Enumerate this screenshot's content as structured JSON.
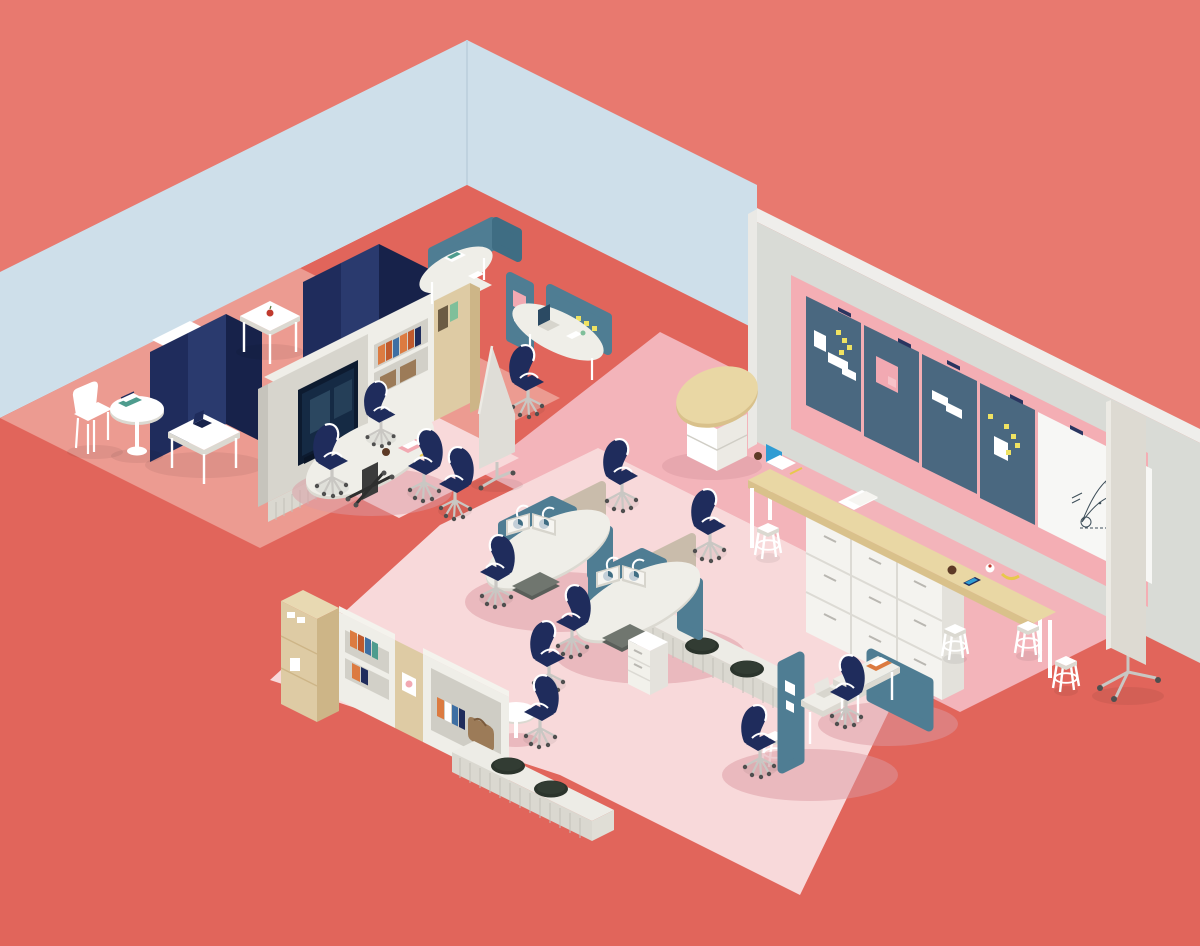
{
  "title": "Isometric open-plan office illustration",
  "colors": {
    "coral_bg": "#E8796F",
    "coral_floor": "#E1655B",
    "salmon_rug": "#EC9B91",
    "pink_rug_medium": "#F3B4BA",
    "pink_rug_pale": "#F8D9DA",
    "wall_blue": "#CEDFEA",
    "wall_gray_face": "#D9DBD6",
    "wall_gray_top": "#EFEEEB",
    "wall_pink_inset": "#F4AEB4",
    "board_slate": "#4A6880",
    "whiteboard": "#F7F7F5",
    "navy": "#1F2C5C",
    "navy_light": "#2A3A6E",
    "navy_dark": "#17224A",
    "slate_panel": "#4F7D93",
    "slate_dark": "#3F6D83",
    "white": "#FFFFFF",
    "desk_white": "#EFEEE8",
    "desk_edge": "#DBD9D1",
    "cabinet_gray": "#D7D5CD",
    "cabinet_gray_dark": "#C6C4BC",
    "plinth": "#DAD8D0",
    "slat_line": "#C2C0B8",
    "wood_tan": "#E9D7A4",
    "wood_tan_dark": "#D9C18B",
    "cabinet_beige": "#DECBA4",
    "cabinet_beige_dark": "#CDB587",
    "cabinet_beige_top": "#E8D9B2",
    "book_orange": "#DC7B41",
    "book_orange_deep": "#C05A2D",
    "book_blue": "#3E6FA3",
    "book_teal": "#4E9C8E",
    "book_brown": "#9C7B58",
    "tv_bezel": "#0D1B30",
    "tv_screen": "#152A44",
    "tv_reflection": "#3E5E78",
    "pouf_dark": "#2B342C",
    "pouf_light": "#39443A",
    "yellow_sticky": "#EFE262",
    "pink_paper": "#F2A9B2",
    "laptop_blue": "#2F9CD3",
    "mug_brown": "#5D3A26",
    "banana_yellow": "#E8C84C",
    "cushion_gray": "#70766F",
    "cushion_gray_dark": "#5A5F5A",
    "chair_frame": "#FFFFFF",
    "base_gray": "#C9C7C3",
    "caster_dark": "#4F4F4F",
    "shadow_pink": "#DC9AA2",
    "marker_ink": "#3D4E59",
    "apple_red": "#C03A2E",
    "plant_green": "#7FBF9A"
  },
  "scene": {
    "zones": [
      {
        "name": "focus-booths",
        "items": [
          "navy high-back privacy booths",
          "white in-booth tables",
          "two dark laptops",
          "white cafe chair",
          "round pedestal table with books",
          "square white table with apple"
        ]
      },
      {
        "name": "media-meeting-area",
        "items": [
          "gray media unit with wall TV",
          "white bookcase with books",
          "beige cabinet with green book",
          "white oval meeting table",
          "pink notepad, mug, pencil",
          "navy task chairs"
        ]
      },
      {
        "name": "cubicle-pods",
        "items": [
          "curved slate privacy panels",
          "laptop",
          "yellow sticky notes",
          "pink pinned paper",
          "navy task chair",
          "mobile pointed divider screen"
        ]
      },
      {
        "name": "standing-counter",
        "items": [
          "long wood-top standing counter",
          "white 9-drawer cabinet",
          "white stools",
          "blue-screen laptop",
          "mugs",
          "phone",
          "banana",
          "papers"
        ]
      },
      {
        "name": "pinboard-wall",
        "items": [
          "gray wall band with pink inset",
          "four slate pinboards",
          "white papers",
          "pink poster",
          "yellow sticky notes",
          "wall whiteboard with hand-drawn chart"
        ]
      },
      {
        "name": "desk-cluster",
        "items": [
          "two dual workstations",
          "dual monitors with pie charts",
          "slate dividers",
          "tan back panels",
          "gray bench cushions",
          "white pedestal drawers",
          "low benches with dark round poufs",
          "small round white table"
        ]
      },
      {
        "name": "storage-wall",
        "items": [
          "tall beige cabinet",
          "white bookcase with books",
          "beige column with poster",
          "white cabinet with books and brown satchel",
          "low bench with dark round poufs"
        ]
      },
      {
        "name": "sw-workstations",
        "items": [
          "two slate-panel desks",
          "silver laptop",
          "orange notebook",
          "pinned papers",
          "navy task chairs"
        ]
      },
      {
        "name": "mobile-whiteboard",
        "items": [
          "free-standing whiteboard screen on casters"
        ]
      }
    ],
    "counts": {
      "task_chairs": 12,
      "stools": 5,
      "poufs": 4,
      "pinboards": 4,
      "booth_pods": 3,
      "monitors": 4
    }
  }
}
